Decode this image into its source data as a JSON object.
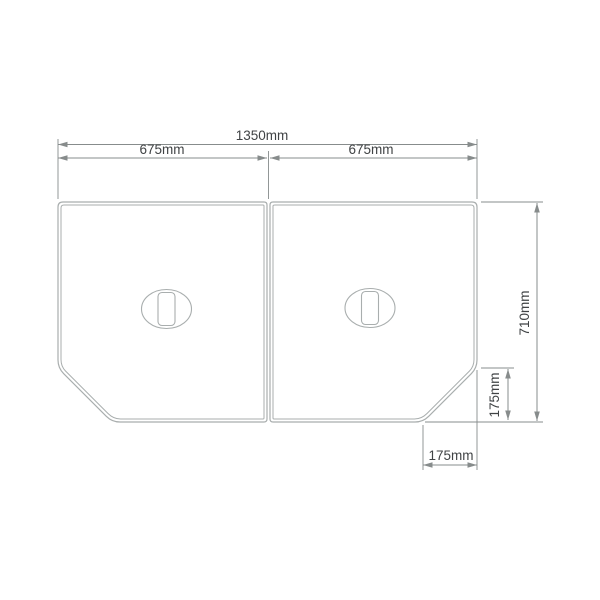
{
  "figure": {
    "dimensions": {
      "total_width": {
        "label": "1350mm"
      },
      "left_panel_width": {
        "label": "675mm"
      },
      "right_panel_width": {
        "label": "675mm"
      },
      "overall_depth": {
        "label": "710mm"
      },
      "corner_cut_depth": {
        "label": "175mm"
      },
      "corner_cut_width": {
        "label": "175mm"
      }
    }
  },
  "colors": {
    "background": "#ffffff",
    "panel_line": "#a9aeae",
    "dimension_line": "#878c8c",
    "text": "#404345"
  }
}
